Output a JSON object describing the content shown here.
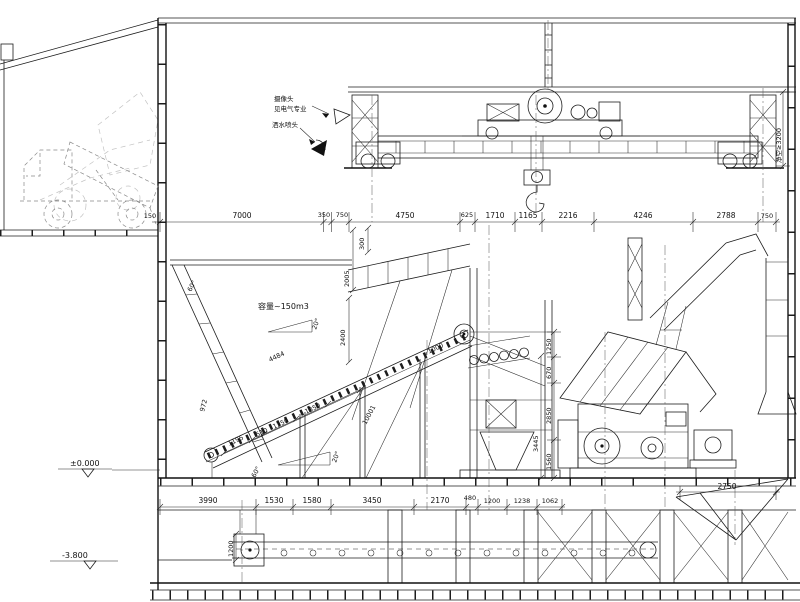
{
  "drawing": {
    "annotations": {
      "camera_line1": "摄像头",
      "camera_line2": "见电气专业",
      "sprinkler": "洒水喷头",
      "capacity": "容量~150m3",
      "clearance": "净空≥3200"
    },
    "levels": {
      "ground": "±0.000",
      "pit": "-3.800"
    },
    "top_dims": {
      "d150": "150",
      "d7000": "7000",
      "d350": "350",
      "d750a": "750",
      "d4750": "4750",
      "d625": "625",
      "d1710": "1710",
      "d1165": "1165",
      "d2216": "2216",
      "d4246": "4246",
      "d2788": "2788",
      "d750b": "750"
    },
    "bottom_dims": {
      "d3990": "3990",
      "d1530": "1530",
      "d1580": "1580",
      "d3450": "3450",
      "d2170": "2170",
      "d480": "480",
      "d1200": "1200",
      "d1238": "1238",
      "d1062": "1062",
      "d2750": "2750"
    },
    "vertical_dims": {
      "d300": "300",
      "d2005": "2005",
      "d2400": "2400",
      "d4484": "4484",
      "d972": "972",
      "d1195": "1195",
      "d510": "510",
      "d1350a": "1350",
      "d1350b": "1350",
      "d10001": "10001",
      "d1000": "~1000",
      "d1250": "1250",
      "d670": "670",
      "d2850": "2850",
      "d3445": "3445",
      "d1560": "1560",
      "d1200pit": "1200"
    },
    "angles": {
      "a60a": "60°",
      "a20a": "20°",
      "a60b": "60°",
      "a20b": "20°"
    }
  }
}
